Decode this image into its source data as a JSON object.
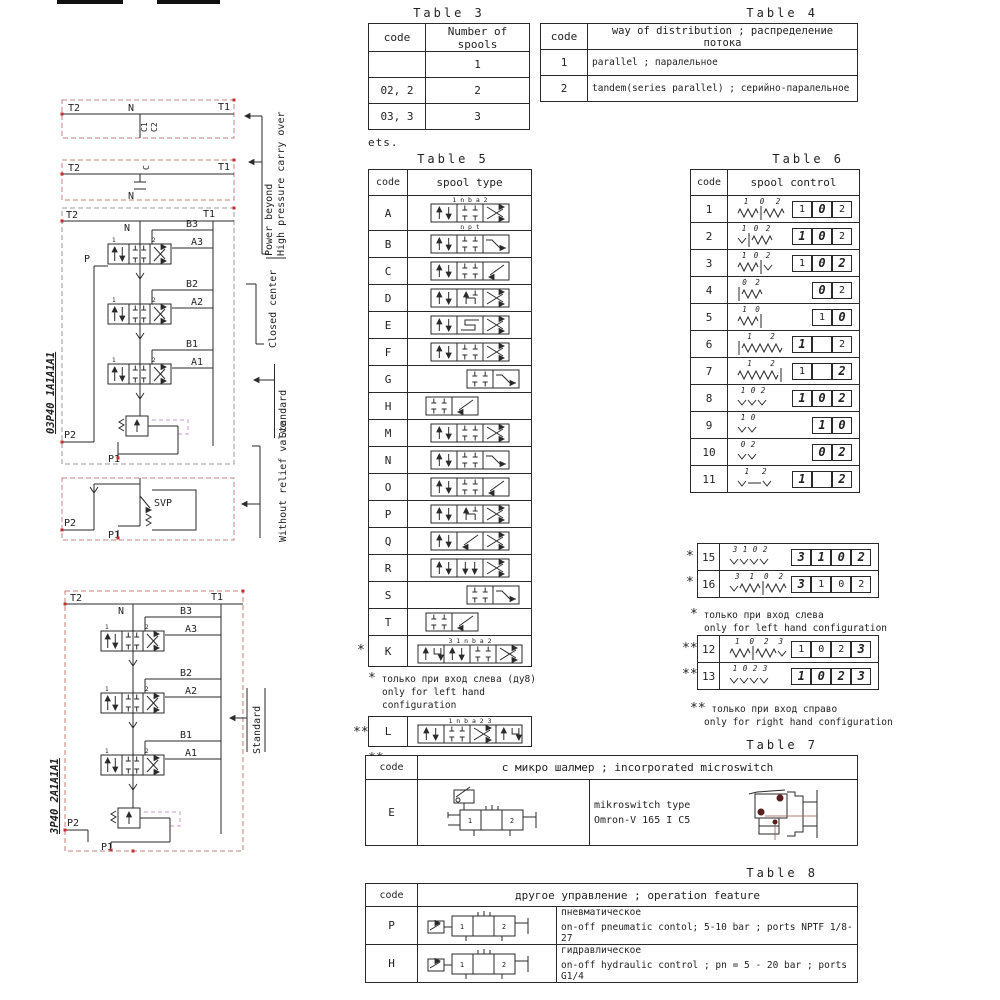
{
  "colors": {
    "line": "#2a2a2a",
    "red_dashed": "#c08080",
    "red_dot": "#c03030",
    "magenta_dashed": "#cc99cc",
    "drawing_accent": "#5a2020"
  },
  "diagrams": {
    "model_top": "03P40 1A1A1A1",
    "model_bottom": "3P40 2A1A1A1",
    "labels": {
      "power_beyond": "Power beyond",
      "high_pressure_carry_over": "High pressure carry over",
      "closed_center": "Closed center",
      "standard": "Standard",
      "without_relief_valve": "Without relief valve"
    },
    "ports": {
      "t2": "T2",
      "t1": "T1",
      "n": "N",
      "c": "C",
      "c1": "C1",
      "c2": "C2",
      "p": "P",
      "p1": "P1",
      "p2": "P2",
      "svp": "SVP",
      "b3": "B3",
      "a3": "A3",
      "b2": "B2",
      "a2": "A2",
      "b1": "B1",
      "a1": "A1"
    },
    "valve_section_labels": [
      "1",
      "2"
    ]
  },
  "table3": {
    "title": "Table 3",
    "headers": [
      "code",
      "Number of spools"
    ],
    "rows": [
      [
        "",
        "1"
      ],
      [
        "02, 2",
        "2"
      ],
      [
        "03, 3",
        "3"
      ]
    ],
    "footnote": "ets."
  },
  "table4": {
    "title": "Table 4",
    "headers": [
      "code",
      "way of distribution ; распределение потока"
    ],
    "rows": [
      [
        "1",
        "parallel ; паралельное"
      ],
      [
        "2",
        "tandem(series parallel) ; серийно-паралельное"
      ]
    ]
  },
  "table5": {
    "title": "Table 5",
    "headers": [
      "code",
      "spool type"
    ],
    "rows": [
      {
        "code": "A",
        "cells": [
          "ud",
          "ct",
          "x"
        ],
        "top": "1    n b a    2",
        "bottom": "n p t"
      },
      {
        "code": "B",
        "cells": [
          "ud",
          "ct",
          "z"
        ]
      },
      {
        "code": "C",
        "cells": [
          "ud",
          "ct",
          "nd"
        ]
      },
      {
        "code": "D",
        "cells": [
          "ud",
          "hh",
          "x"
        ]
      },
      {
        "code": "E",
        "cells": [
          "ud",
          "ss",
          "x"
        ]
      },
      {
        "code": "F",
        "cells": [
          "ud",
          "ct",
          "x"
        ]
      },
      {
        "code": "G",
        "cells": [
          "ct",
          "z"
        ],
        "align": "right"
      },
      {
        "code": "H",
        "cells": [
          "ct",
          "nd"
        ],
        "align": "left"
      },
      {
        "code": "M",
        "cells": [
          "ud",
          "ct",
          "x"
        ]
      },
      {
        "code": "N",
        "cells": [
          "ud",
          "ct",
          "z"
        ]
      },
      {
        "code": "O",
        "cells": [
          "ud",
          "ct",
          "nd"
        ]
      },
      {
        "code": "P",
        "cells": [
          "ud",
          "hh",
          "x"
        ]
      },
      {
        "code": "Q",
        "cells": [
          "ud",
          "nd",
          "x"
        ]
      },
      {
        "code": "R",
        "cells": [
          "ud",
          "dd",
          "x"
        ]
      },
      {
        "code": "S",
        "cells": [
          "ct",
          "z"
        ],
        "align": "right"
      },
      {
        "code": "T",
        "cells": [
          "ct",
          "nd"
        ],
        "align": "left"
      },
      {
        "code": "K",
        "cells": [
          "rg",
          "ud",
          "ct",
          "x"
        ],
        "top": "3   1   n b a   2",
        "marker": "*"
      }
    ],
    "l_row": {
      "code": "L",
      "cells": [
        "ud",
        "ct",
        "x",
        "rg"
      ],
      "top": "1   n b a   2   3",
      "marker": "**"
    },
    "note_left": {
      "marker": "*",
      "ru": "только при вход слева (ду8)",
      "en": "only for left hand configuration"
    },
    "note_right": {
      "marker": "**",
      "ru": "только при вход справо (ду8)",
      "en": "only for right hand configuration"
    }
  },
  "table6": {
    "title": "Table 6",
    "headers": [
      "code",
      "spool control"
    ],
    "rows": [
      {
        "code": "1",
        "ctrl": [
          "spr",
          "bar",
          "spr"
        ],
        "labels": [
          "1",
          "0",
          "2"
        ],
        "boxes": [
          {
            "t": "1"
          },
          {
            "t": "0",
            "b": true
          },
          {
            "t": "2"
          }
        ]
      },
      {
        "code": "2",
        "ctrl": [
          "det",
          "bar",
          "spr"
        ],
        "labels": [
          "1",
          "0",
          "2"
        ],
        "boxes": [
          {
            "t": "1",
            "b": true
          },
          {
            "t": "0",
            "b": true
          },
          {
            "t": "2"
          }
        ]
      },
      {
        "code": "3",
        "ctrl": [
          "spr",
          "bar",
          "det"
        ],
        "labels": [
          "1",
          "0",
          "2"
        ],
        "boxes": [
          {
            "t": "1"
          },
          {
            "t": "0",
            "b": true
          },
          {
            "t": "2",
            "b": true
          }
        ]
      },
      {
        "code": "4",
        "ctrl": [
          "bar",
          "spr"
        ],
        "labels": [
          "0",
          "2"
        ],
        "boxes": [
          {
            "t": "0",
            "b": true
          },
          {
            "t": "2"
          }
        ],
        "offset": 1
      },
      {
        "code": "5",
        "ctrl": [
          "spr",
          "bar"
        ],
        "labels": [
          "1",
          "0"
        ],
        "boxes": [
          {
            "t": "1"
          },
          {
            "t": "0",
            "b": true
          }
        ]
      },
      {
        "code": "6",
        "ctrl": [
          "bar",
          "sprl"
        ],
        "labels": [
          "1",
          "2"
        ],
        "boxes": [
          {
            "t": "1",
            "b": true
          },
          {
            "t": ""
          },
          {
            "t": "2"
          }
        ]
      },
      {
        "code": "7",
        "ctrl": [
          "sprl",
          "bar"
        ],
        "labels": [
          "1",
          "2"
        ],
        "boxes": [
          {
            "t": "1"
          },
          {
            "t": ""
          },
          {
            "t": "2",
            "b": true
          }
        ]
      },
      {
        "code": "8",
        "ctrl": [
          "det",
          "det",
          "det"
        ],
        "labels": [
          "1",
          "0",
          "2"
        ],
        "boxes": [
          {
            "t": "1",
            "b": true
          },
          {
            "t": "0",
            "b": true
          },
          {
            "t": "2",
            "b": true
          }
        ]
      },
      {
        "code": "9",
        "ctrl": [
          "det",
          "det"
        ],
        "labels": [
          "1",
          "0"
        ],
        "boxes": [
          {
            "t": "1",
            "b": true
          },
          {
            "t": "0",
            "b": true
          }
        ]
      },
      {
        "code": "10",
        "ctrl": [
          "det",
          "det"
        ],
        "labels": [
          "0",
          "2"
        ],
        "boxes": [
          {
            "t": "0",
            "b": true
          },
          {
            "t": "2",
            "b": true
          }
        ],
        "offset": 1
      },
      {
        "code": "11",
        "ctrl": [
          "det",
          "dash",
          "det"
        ],
        "labels": [
          "1",
          "2"
        ],
        "boxes": [
          {
            "t": "1",
            "b": true
          },
          {
            "t": ""
          },
          {
            "t": "2",
            "b": true
          }
        ]
      }
    ],
    "extra_blocks": [
      {
        "marker": "*",
        "rows": [
          {
            "code": "15",
            "ctrl": [
              "det",
              "det",
              "det",
              "det"
            ],
            "labels": [
              "3",
              "1",
              "0",
              "2"
            ],
            "boxes": [
              {
                "t": "3",
                "b": true
              },
              {
                "t": "1",
                "b": true
              },
              {
                "t": "0",
                "b": true
              },
              {
                "t": "2",
                "b": true
              }
            ]
          },
          {
            "code": "16",
            "ctrl": [
              "det",
              "spr",
              "bar",
              "spr"
            ],
            "labels": [
              "3",
              "1",
              "0",
              "2"
            ],
            "boxes": [
              {
                "t": "3",
                "b": true
              },
              {
                "t": "1"
              },
              {
                "t": "0"
              },
              {
                "t": "2"
              }
            ]
          }
        ],
        "note": {
          "marker": "*",
          "ru": "только при вход слева",
          "en": "only for left hand configuration"
        }
      },
      {
        "marker": "**",
        "rows": [
          {
            "code": "12",
            "ctrl": [
              "spr",
              "bar",
              "spr",
              "det"
            ],
            "labels": [
              "1",
              "0",
              "2",
              "3"
            ],
            "boxes": [
              {
                "t": "1"
              },
              {
                "t": "0"
              },
              {
                "t": "2"
              },
              {
                "t": "3",
                "b": true
              }
            ]
          },
          {
            "code": "13",
            "ctrl": [
              "det",
              "det",
              "det",
              "det"
            ],
            "labels": [
              "1",
              "0",
              "2",
              "3"
            ],
            "boxes": [
              {
                "t": "1",
                "b": true
              },
              {
                "t": "0",
                "b": true
              },
              {
                "t": "2",
                "b": true
              },
              {
                "t": "3",
                "b": true
              }
            ]
          }
        ],
        "note": {
          "marker": "**",
          "ru": "только при вход справо",
          "en": "only for right hand configuration"
        }
      }
    ]
  },
  "table7": {
    "title": "Table 7",
    "header_code": "code",
    "header_desc": "с микро шалмер ; incorporated microswitch",
    "row": {
      "code": "E",
      "line1": "mikroswitch type",
      "line2": "Omron-V 165 I C5",
      "valve_labels": [
        "1",
        "2"
      ]
    }
  },
  "table8": {
    "title": "Table 8",
    "header_code": "code",
    "header_desc": "другое управление ; operation feature",
    "rows": [
      {
        "code": "P",
        "ru": "пневматическое",
        "en": "on-off pneumatic contol; 5-10 bar ; ports NPTF 1/8-27"
      },
      {
        "code": "H",
        "ru": "гидравлическое",
        "en": "on-off hydraulic control ; pn = 5 - 20 bar ; ports G1/4"
      }
    ]
  }
}
